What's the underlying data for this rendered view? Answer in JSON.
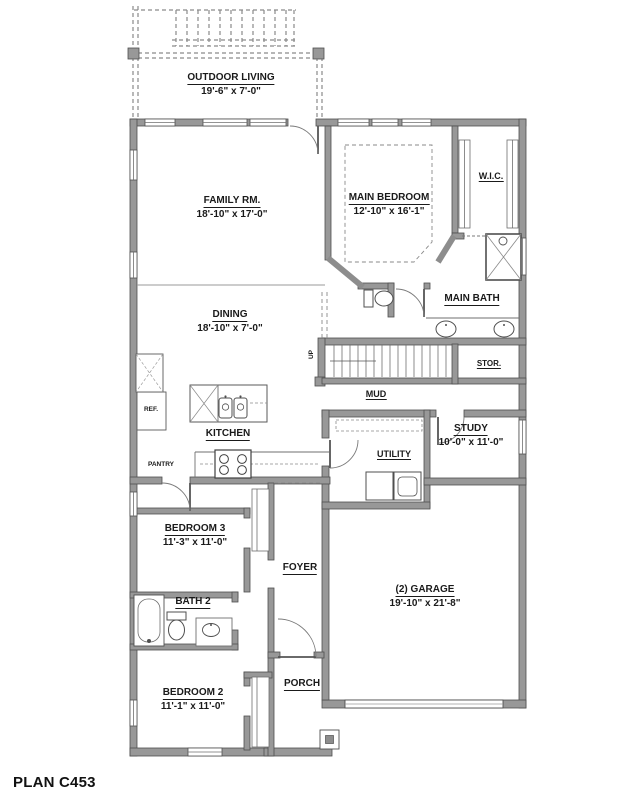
{
  "plan": {
    "title": "PLAN C453"
  },
  "rooms": {
    "outdoor_living": {
      "name": "OUTDOOR LIVING",
      "dims": "19'-6\" x 7'-0\""
    },
    "family": {
      "name": "FAMILY RM.",
      "dims": "18'-10\" x 17'-0\""
    },
    "main_bedroom": {
      "name": "MAIN BEDROOM",
      "dims": "12'-10\" x 16'-1\""
    },
    "wic": {
      "name": "W.I.C."
    },
    "main_bath": {
      "name": "MAIN BATH"
    },
    "dining": {
      "name": "DINING",
      "dims": "18'-10\" x 7'-0\""
    },
    "stor": {
      "name": "STOR."
    },
    "mud": {
      "name": "MUD"
    },
    "kitchen": {
      "name": "KITCHEN"
    },
    "utility": {
      "name": "UTILITY"
    },
    "study": {
      "name": "STUDY",
      "dims": "10'-0\" x 11'-0\""
    },
    "bedroom3": {
      "name": "BEDROOM 3",
      "dims": "11'-3\" x 11'-0\""
    },
    "foyer": {
      "name": "FOYER"
    },
    "bath2": {
      "name": "BATH 2"
    },
    "bedroom2": {
      "name": "BEDROOM 2",
      "dims": "11'-1\" x 11'-0\""
    },
    "porch": {
      "name": "PORCH"
    },
    "garage": {
      "name": "(2) GARAGE",
      "dims": "19'-10\" x 21'-8\""
    }
  },
  "annotations": {
    "ref": "REF.",
    "pantry": "PANTRY",
    "up": "UP"
  },
  "colors": {
    "background": "#ffffff",
    "wall_fill": "#989898",
    "wall_outline": "#4f4f4f",
    "thin_line": "#6f6f6f",
    "text": "#1a1a1a"
  }
}
